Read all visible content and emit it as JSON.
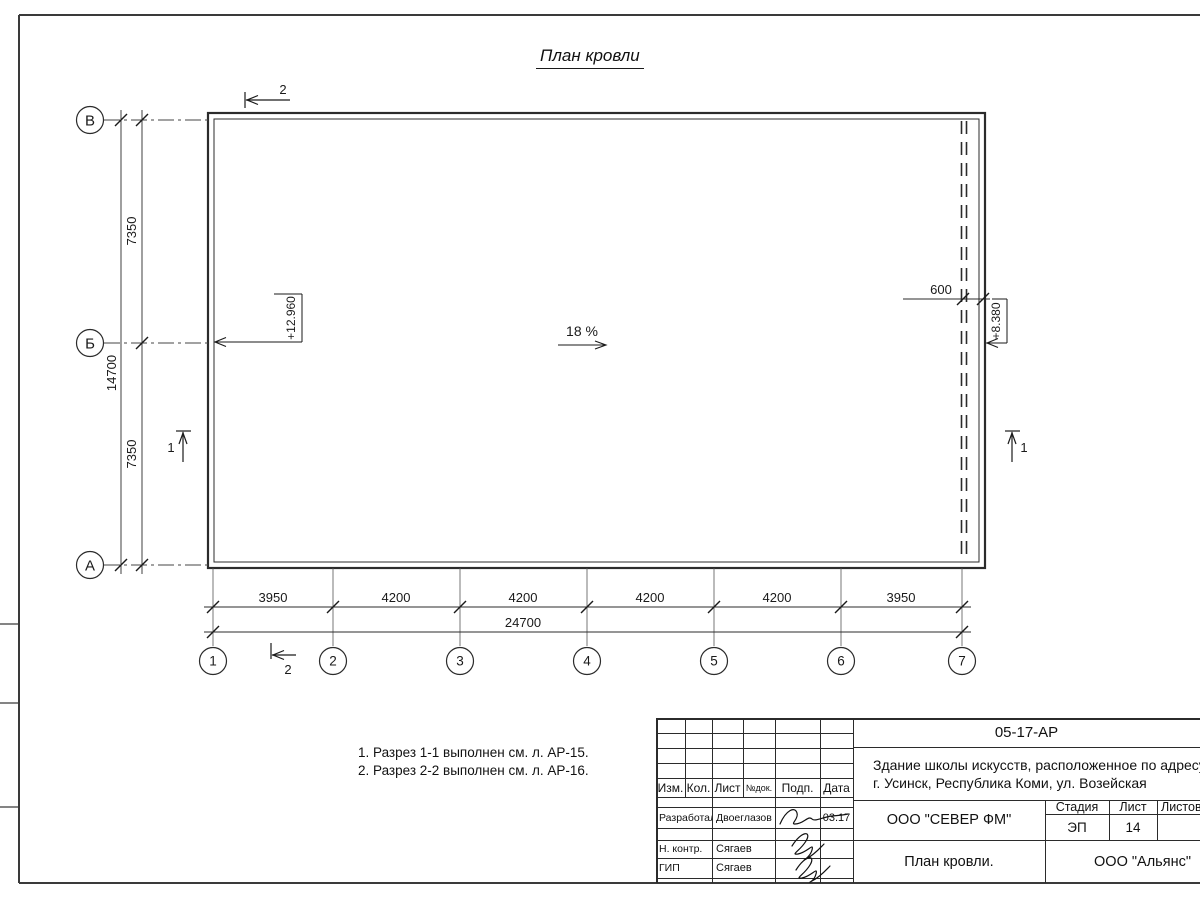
{
  "drawing": {
    "title": "План кровли",
    "slope_label": "18 %",
    "elevation_left": "+12.960",
    "elevation_right": "+8.380",
    "offset_dim": "600",
    "row_axes": [
      "В",
      "Б",
      "А"
    ],
    "col_axes": [
      "1",
      "2",
      "3",
      "4",
      "5",
      "6",
      "7"
    ],
    "left_dims": [
      "7350",
      "7350"
    ],
    "left_total": "14700",
    "bottom_dims": [
      "3950",
      "4200",
      "4200",
      "4200",
      "4200",
      "3950"
    ],
    "bottom_total": "24700",
    "section1": "1",
    "section2": "2",
    "notes": [
      "1. Разрез 1-1 выполнен см. л. АР-15.",
      "2. Разрез 2-2 выполнен см. л. АР-16."
    ]
  },
  "title_block": {
    "doc_number": "05-17-АР",
    "project_line1": "Здание школы искусств, расположенное по адресу:",
    "project_line2": "г. Усинск, Республика Коми, ул. Возейская",
    "col_headers": [
      "Изм.",
      "Кол.",
      "Лист",
      "№док.",
      "Подп.",
      "Дата"
    ],
    "row_developed_label": "Разработал",
    "row_developed_name": "Двоеглазов",
    "row_developed_date": "03.17",
    "row_ncontr_label": "Н. контр.",
    "row_ncontr_name": "Сягаев",
    "row_gip_label": "ГИП",
    "row_gip_name": "Сягаев",
    "company": "ООО \"СЕВЕР ФМ\"",
    "stage_label": "Стадия",
    "sheet_label": "Лист",
    "sheets_label": "Листов",
    "stage_value": "ЭП",
    "sheet_value": "14",
    "sheets_value": "",
    "sheet_title": "План кровли.",
    "contractor": "ООО \"Альянс\""
  }
}
